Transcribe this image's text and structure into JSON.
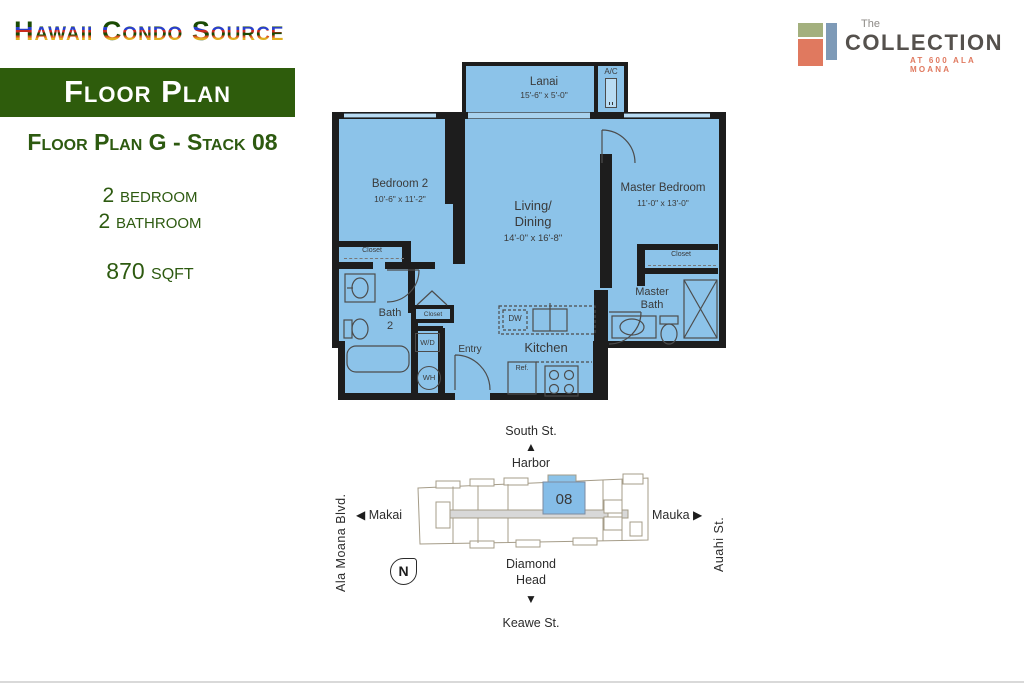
{
  "header": {
    "site_name": "Hawaii Condo Source",
    "collection": {
      "the": "The",
      "name": "COLLECTION",
      "tagline": "AT 600 ALA MOANA"
    }
  },
  "sidebar": {
    "banner": "Floor Plan",
    "plan_title": "Floor Plan G - Stack 08",
    "bedrooms": "2 bedroom",
    "bathrooms": "2 bathroom",
    "area": "870 sqft"
  },
  "plan": {
    "lanai": {
      "name": "Lanai",
      "dims": "15'-6\" x 5'-0\""
    },
    "bedroom2": {
      "name": "Bedroom 2",
      "dims": "10'-6\" x 11'-2\""
    },
    "living": {
      "line1": "Living/",
      "line2": "Dining",
      "dims": "14'-0\" x 16'-8\""
    },
    "master": {
      "name": "Master Bedroom",
      "dims": "11'-0\" x 13'-0\""
    },
    "bath2": {
      "line1": "Bath",
      "line2": "2"
    },
    "master_bath": {
      "line1": "Master",
      "line2": "Bath"
    },
    "kitchen": "Kitchen",
    "entry": "Entry",
    "ac": "A/C",
    "wd": "W/D",
    "wh": "WH",
    "dw": "DW",
    "ref": "Ref.",
    "closet_bedroom2": "Closet",
    "closet_entry": "Closet",
    "closet_master": "Closet"
  },
  "map": {
    "unit": "08",
    "north": "N",
    "top": {
      "street": "South St.",
      "direction": "Harbor"
    },
    "bottom": {
      "direction_line1": "Diamond",
      "direction_line2": "Head",
      "street": "Keawe St."
    },
    "left": {
      "street": "Ala Moana Blvd.",
      "direction": "Makai"
    },
    "right": {
      "street": "Auahi St.",
      "direction": "Mauka"
    }
  },
  "icons": {
    "up": "▲",
    "down": "▼",
    "left": "◀",
    "right": "▶"
  },
  "colors": {
    "accent_green": "#2d5a10",
    "plan_blue": "#8cc3e9",
    "wall_black": "#1d1d1d",
    "map_outline": "#a59c88",
    "logo_coral": "#e0795f",
    "logo_sage": "#a3b07e",
    "logo_slate": "#7e9ab7"
  }
}
